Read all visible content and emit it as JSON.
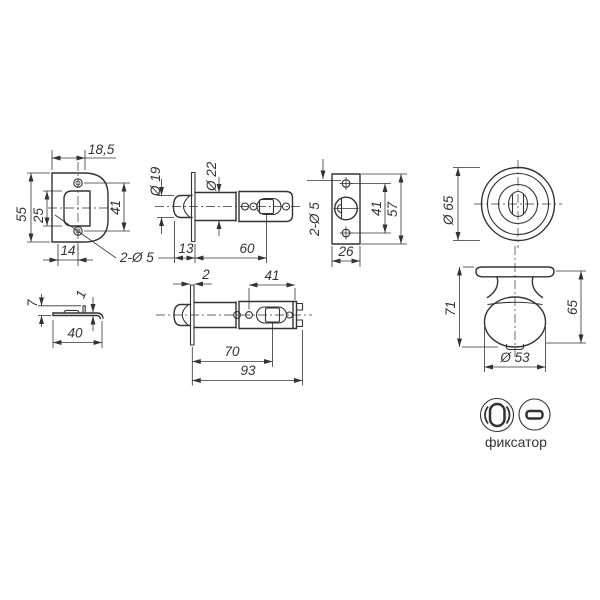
{
  "drawing": {
    "caption": "фиксатор",
    "colors": {
      "ink": "#333333",
      "background": "#ffffff"
    },
    "views": {
      "faceplate_front": {
        "dim_edge_to_axis": "18,5",
        "dim_height": "55",
        "dim_window_height": "25",
        "dim_hole_spacing": "41",
        "dim_bottom_offset": "14",
        "dim_holes": "2-Ø 5"
      },
      "latch_backset60": {
        "dim_bolt_dia": "Ø 19",
        "dim_body_dia": "Ø 22",
        "dim_bolt_length": "13",
        "dim_backset": "60"
      },
      "strike_box": {
        "dim_holes": "2-Ø 5",
        "dim_hole_spacing": "41",
        "dim_height": "57",
        "dim_width": "26"
      },
      "rose_front": {
        "dim_dia": "Ø 65"
      },
      "strike_plate_side": {
        "dim_height": "7",
        "dim_thickness": "1",
        "dim_width": "40"
      },
      "latch_backset70": {
        "dim_plate_thickness": "2",
        "dim_tail": "41",
        "dim_backset": "70",
        "dim_total_length": "93"
      },
      "knob_side": {
        "dim_total_height": "71",
        "dim_knob_height": "65",
        "dim_knob_dia": "Ø 53"
      },
      "fixator_icons": {
        "label": "фиксатор"
      }
    }
  }
}
